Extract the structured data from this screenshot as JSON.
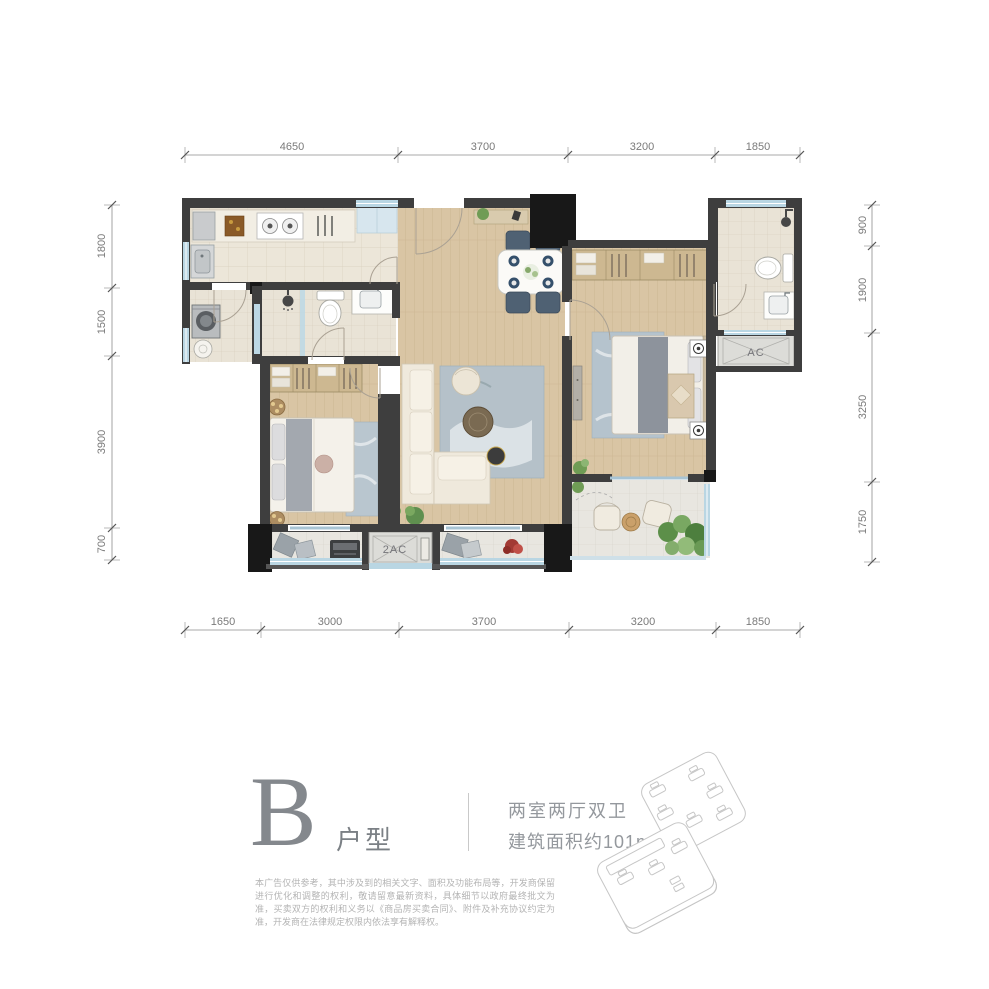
{
  "dimensions": {
    "top": [
      "4650",
      "3700",
      "3200",
      "1850"
    ],
    "bottom": [
      "1650",
      "3000",
      "3700",
      "3200",
      "1850"
    ],
    "left": [
      "1800",
      "1500",
      "3900",
      "700"
    ],
    "right": [
      "900",
      "1900",
      "3250",
      "1750"
    ]
  },
  "plan_labels": {
    "ac": "AC",
    "ac2": "2AC"
  },
  "footer": {
    "unit_letter": "B",
    "unit_suffix": "户型",
    "summary_line1": "两室两厅双卫",
    "summary_line2": "建筑面积约101m²",
    "disclaimer_line1": "本广告仅供参考，其中涉及到的相关文字、面积及功能布局等，开发商保留进行优化和调整的权利，敬",
    "disclaimer_line2": "请留意最新资料，具体细节以政府最终批文为准，买卖双方的权利和义务以《商品房买卖合同》、附件及",
    "disclaimer_line3": "补充协议约定为准，开发商在法律规定权限内依法享有解释权。"
  },
  "colors": {
    "wall": "#3e3e3e",
    "wall_dark": "#181818",
    "window": "#b9d6e3",
    "wood_floor": "#d9c5a4",
    "tile_floor": "#ece6d9",
    "dimension_text": "#7a7a7a",
    "footer_text": "#84888d"
  }
}
